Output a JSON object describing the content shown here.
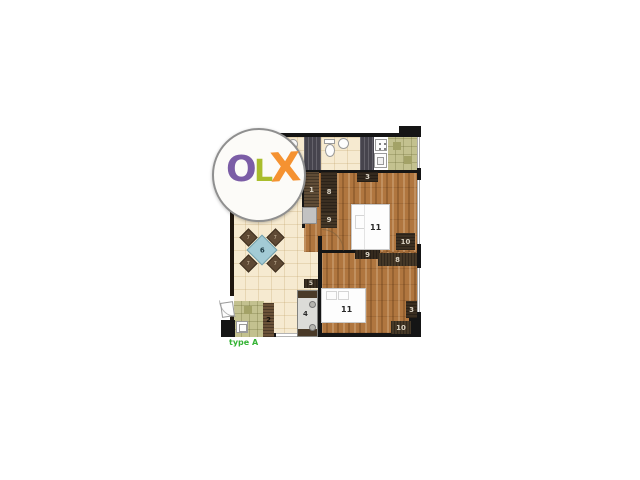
{
  "watermark": {
    "letter_o": "O",
    "letter_l": "L",
    "letter_x": "X",
    "o_color": "#7b5da6",
    "l_color": "#a9bd2c",
    "x_color": "#f59231",
    "ring_color": "#8f8f8f"
  },
  "caption": {
    "text": "type A",
    "color": "#35b335"
  },
  "plan": {
    "colors": {
      "wall": "#151515",
      "living_floor": "#f6ead0",
      "wood_floor": "#b0763f",
      "kitchen_floor": "#c3c18f",
      "shaft": "#46444d",
      "table": "#a3cbd5"
    },
    "labels": {
      "hall_closet_1": "1",
      "hall_closet_8": "8",
      "hall_closet_9": "9",
      "bed1_closet_top": "3",
      "bed1_bed": "11",
      "bed1_closet_right": "10",
      "divider_left": "9",
      "divider_right": "8",
      "bed2_bed": "11",
      "bed2_closet_right": "3",
      "bed2_closet_bottom": "10",
      "tv_unit": "5",
      "sofa": "4",
      "kitchen_unit": "2",
      "dining_table": "6",
      "chair": "7"
    }
  }
}
